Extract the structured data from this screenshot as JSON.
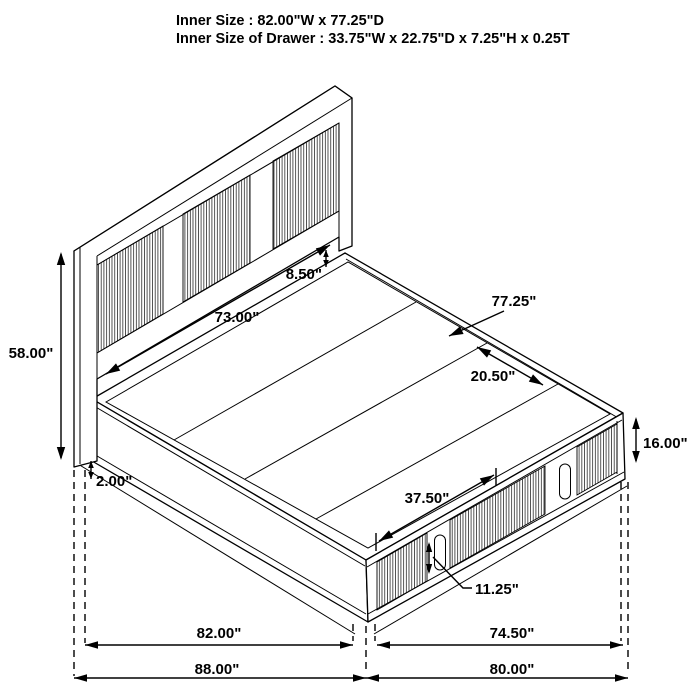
{
  "title": {
    "line1": "Inner Size : 82.00\"W x 77.25\"D",
    "line2": "Inner Size of Drawer : 33.75\"W x 22.75\"D x 7.25\"H x 0.25T"
  },
  "dimensions": {
    "headboard_height": "58.00\"",
    "headboard_width": "73.00\"",
    "deck_to_rail": "8.50\"",
    "depth": "77.25\"",
    "slat_gap": "20.50\"",
    "base_height": "16.00\"",
    "leg_height": "2.00\"",
    "drawer_width": "37.50\"",
    "drawer_height": "11.25\"",
    "inner_width": "82.00\"",
    "inner_depth": "74.50\"",
    "overall_width": "88.00\"",
    "overall_depth": "80.00\""
  },
  "colors": {
    "line": "#000000",
    "background": "#ffffff"
  }
}
